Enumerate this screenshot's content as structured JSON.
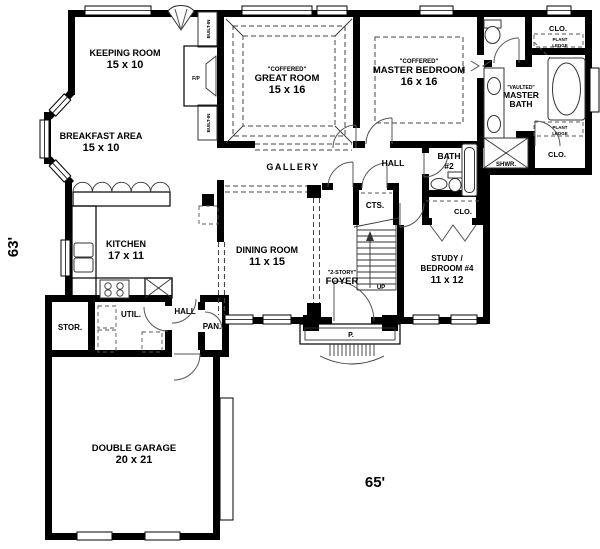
{
  "plan": {
    "width_dimension": "65'",
    "height_dimension": "63'"
  },
  "rooms": {
    "keeping_room": {
      "name": "KEEPING ROOM",
      "size": "15 x 10"
    },
    "breakfast_area": {
      "name": "BREAKFAST AREA",
      "size": "15 x 10"
    },
    "great_room": {
      "ceiling": "\"COFFERED\"",
      "name": "GREAT ROOM",
      "size": "15 x 16"
    },
    "master_bedroom": {
      "ceiling": "\"COFFERED\"",
      "name": "MASTER BEDROOM",
      "size": "16 x 16"
    },
    "master_bath": {
      "ceiling": "\"VAULTED\"",
      "name_line1": "MASTER",
      "name_line2": "BATH"
    },
    "gallery": {
      "name": "GALLERY"
    },
    "hall_rear": {
      "name": "HALL"
    },
    "hall_side": {
      "name": "HALL"
    },
    "kitchen": {
      "name": "KITCHEN",
      "size": "17 x 11"
    },
    "dining_room": {
      "name": "DINING ROOM",
      "size": "11 x 15"
    },
    "foyer": {
      "ceiling": "\"2-STORY\"",
      "name": "FOYER"
    },
    "study": {
      "name_line1": "STUDY /",
      "name_line2": "BEDROOM #4",
      "size": "11 x 12"
    },
    "bath_2": {
      "name_line1": "BATH",
      "name_line2": "#2"
    },
    "coats_closet": {
      "name": "CTS."
    },
    "closet_hall": {
      "name": "CLO."
    },
    "closet_master_top": {
      "name": "CLO."
    },
    "closet_master_bottom": {
      "name": "CLO."
    },
    "plant_ledge_top": {
      "line1": "PLANT",
      "line2": "LEDGE"
    },
    "plant_ledge_bottom": {
      "line1": "PLANT",
      "line2": "LEDGE"
    },
    "shower": {
      "name": "SHWR."
    },
    "storage": {
      "name": "STOR."
    },
    "utility": {
      "name": "UTIL."
    },
    "pantry": {
      "name": "PAN."
    },
    "double_garage": {
      "name": "DOUBLE GARAGE",
      "size": "20 x 21"
    },
    "porch": {
      "name": "P."
    },
    "stairs": {
      "direction": "UP"
    },
    "fireplace": {
      "name": "F/P"
    },
    "builtin_top": {
      "name": "BUILT-IN"
    },
    "builtin_bottom": {
      "name": "BUILT-IN"
    }
  },
  "colors": {
    "walls": "#000000",
    "background": "#ffffff",
    "detail_lines": "#444444"
  }
}
